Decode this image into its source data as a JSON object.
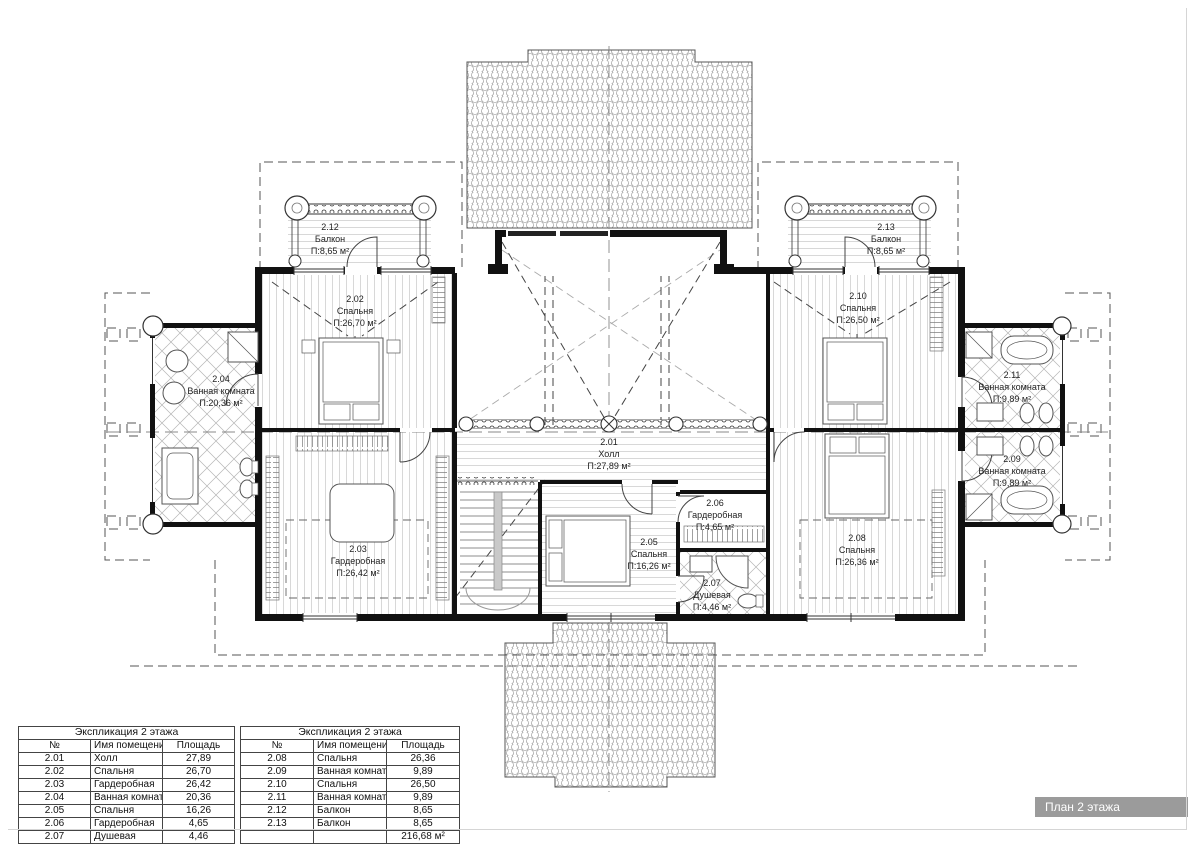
{
  "plan": {
    "rooms": [
      {
        "number": "2.01",
        "name": "Холл",
        "area": "П:27,89 м²"
      },
      {
        "number": "2.02",
        "name": "Спальня",
        "area": "П:26,70 м²"
      },
      {
        "number": "2.03",
        "name": "Гардеробная",
        "area": "П:26,42 м²"
      },
      {
        "number": "2.04",
        "name": "Ванная комната",
        "area": "П:20,36 м²"
      },
      {
        "number": "2.05",
        "name": "Спальня",
        "area": "П:16,26 м²"
      },
      {
        "number": "2.06",
        "name": "Гардеробная",
        "area": "П:4,65 м²"
      },
      {
        "number": "2.07",
        "name": "Душевая",
        "area": "П:4,46 м²"
      },
      {
        "number": "2.08",
        "name": "Спальня",
        "area": "П:26,36 м²"
      },
      {
        "number": "2.09",
        "name": "Ванная комната",
        "area": "П:9,89 м²"
      },
      {
        "number": "2.10",
        "name": "Спальня",
        "area": "П:26,50 м²"
      },
      {
        "number": "2.11",
        "name": "Ванная комната",
        "area": "П:9,89 м²"
      },
      {
        "number": "2.12",
        "name": "Балкон",
        "area": "П:8,65 м²"
      },
      {
        "number": "2.13",
        "name": "Балкон",
        "area": "П:8,65 м²"
      }
    ]
  },
  "tables": [
    {
      "title": "Экспликация 2 этажа",
      "headers": [
        "№",
        "Имя помещения",
        "Площадь"
      ],
      "rows": [
        [
          "2.01",
          "Холл",
          "27,89"
        ],
        [
          "2.02",
          "Спальня",
          "26,70"
        ],
        [
          "2.03",
          "Гардеробная",
          "26,42"
        ],
        [
          "2.04",
          "Ванная комната",
          "20,36"
        ],
        [
          "2.05",
          "Спальня",
          "16,26"
        ],
        [
          "2.06",
          "Гардеробная",
          "4,65"
        ],
        [
          "2.07",
          "Душевая",
          "4,46"
        ]
      ]
    },
    {
      "title": "Экспликация 2 этажа",
      "headers": [
        "№",
        "Имя помещения",
        "Площадь"
      ],
      "rows": [
        [
          "2.08",
          "Спальня",
          "26,36"
        ],
        [
          "2.09",
          "Ванная комната",
          "9,89"
        ],
        [
          "2.10",
          "Спальня",
          "26,50"
        ],
        [
          "2.11",
          "Ванная комната",
          "9,89"
        ],
        [
          "2.12",
          "Балкон",
          "8,65"
        ],
        [
          "2.13",
          "Балкон",
          "8,65"
        ]
      ],
      "total": "216,68 м²"
    }
  ],
  "title_box": {
    "label": "План 2 этажа"
  },
  "colors": {
    "title_box_bg": "#9b9b9b",
    "line": "#111111",
    "hatch": "#b5b5b5"
  }
}
